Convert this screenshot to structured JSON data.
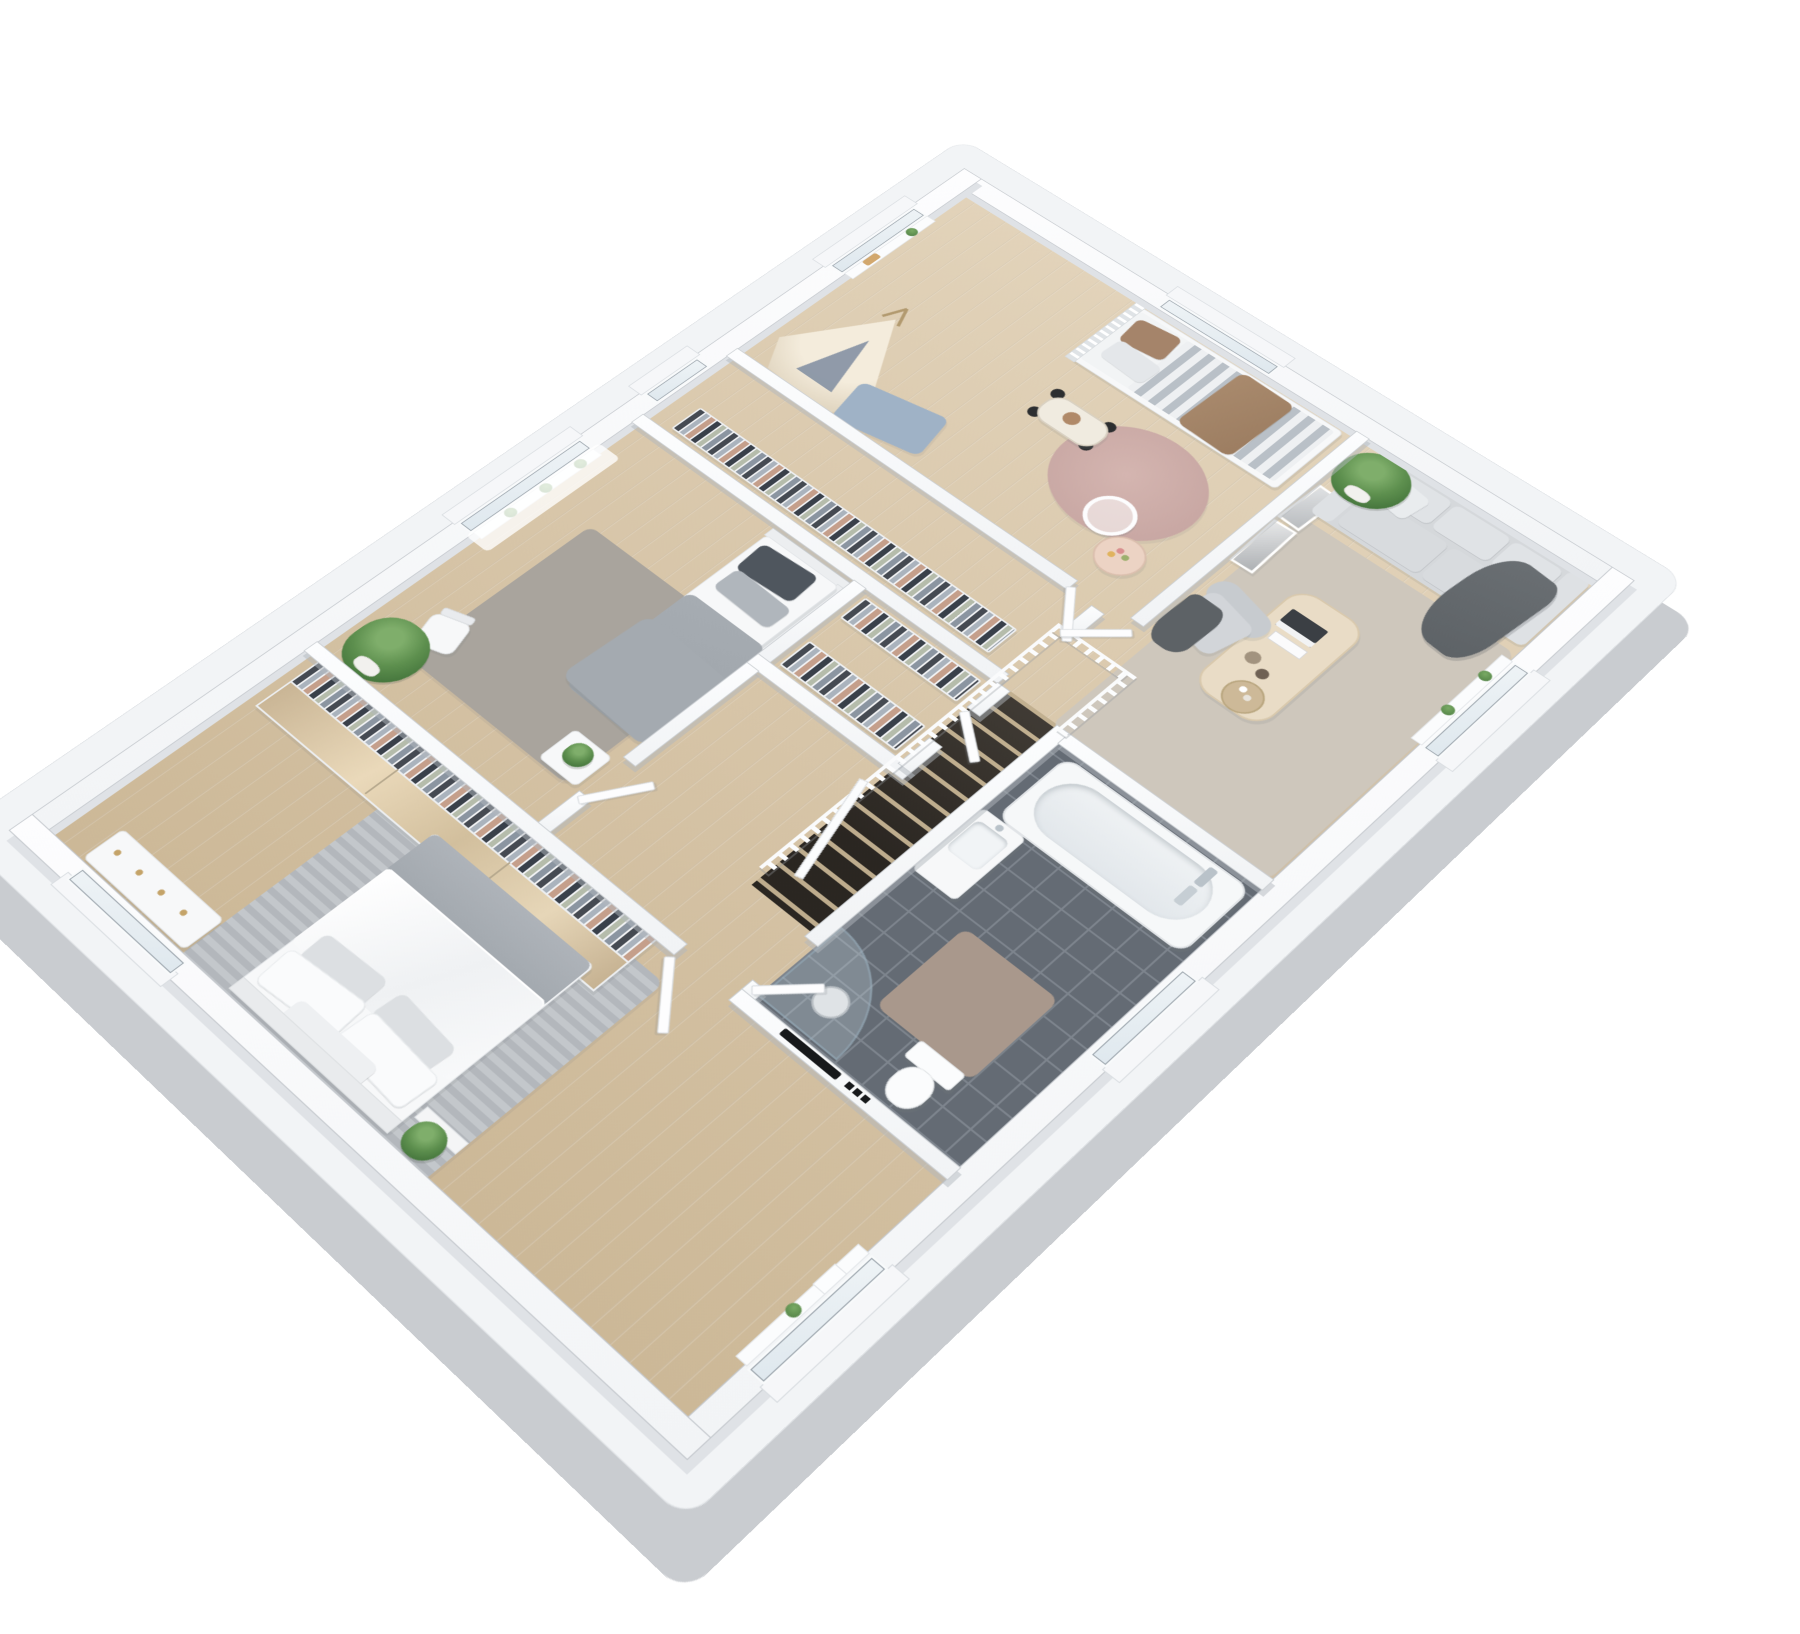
{
  "scene": {
    "type": "3d-floorplan-render",
    "view": "isometric-top-down",
    "floor_materials": {
      "main": "light-oak-plank",
      "bathroom": "anthracite-tile",
      "walls": "white"
    }
  },
  "colors": {
    "background": "#ffffff",
    "slab_top": "#f2f4f6",
    "slab_side": "#c9ccd0",
    "wall": "#fafbfc",
    "wall_edge": "#c5c9ce",
    "wood_light": "#e2d3ba",
    "wood_mid": "#d7c5a8",
    "wood_dark": "#ccb897",
    "tile_floor": "#646b74",
    "tile_grout": "#7d848d",
    "rug_lounge": "#cec7bc",
    "rug_master": "#b7babf",
    "rug_bedroom": "#a9a49d",
    "rug_kids": "#c8a7a3",
    "bath_mat": "#a9988c",
    "sofa": "#d5d8db",
    "throw_dark": "#5d6266",
    "bed_white": "#f5f6f7",
    "blanket_gray": "#9da3a9",
    "pillow_dark": "#4f565e",
    "kids_brown": "#9c7d61",
    "stair_void": "#413c36",
    "glass": "#dfe8ee",
    "plant_green": "#5d8f4e",
    "mirror_wood": "#d6c3a6",
    "tv_black": "#17191b"
  },
  "rooms": {
    "kids_bedroom": {
      "id": "kids-bedroom",
      "floor": "wood",
      "furniture": [
        "single-bed",
        "striped-duvet",
        "brown-pillow",
        "brown-throw",
        "teepee-tent",
        "blue-play-mat",
        "toy-pedal-car",
        "round-rug",
        "wire-chair",
        "play-table",
        "leaning-pictures"
      ],
      "windows": 2
    },
    "lounge": {
      "id": "lounge",
      "floor": "wood",
      "furniture": [
        "three-seat-sofa",
        "back-cushions",
        "seat-cushions",
        "dark-throw",
        "coffee-table",
        "books",
        "vases",
        "serving-tray",
        "armchair",
        "armchair-throw",
        "area-rug",
        "corner-potted-plant"
      ],
      "windows": 1
    },
    "bathroom": {
      "id": "bathroom",
      "floor": "dark-gray-tile",
      "walls": "white-subway-tile",
      "furniture": [
        "bathtub",
        "chrome-bath-mixer",
        "floating-vanity",
        "basin",
        "curved-shower-enclosure",
        "floor-drain",
        "toilet",
        "bath-mat"
      ],
      "windows": 1
    },
    "staircase": {
      "id": "staircase",
      "furniture": [
        "white-railing",
        "balusters",
        "descending-handrail",
        "wood-landing",
        "stair-void-with-treads"
      ]
    },
    "hallway": {
      "id": "hallway",
      "floor": "wood",
      "furniture": [
        "white-doors"
      ]
    },
    "closet_upper": {
      "id": "walk-in-closet-upper",
      "furniture": [
        "clothes-rail",
        "hanging-clothes"
      ],
      "windows": 1
    },
    "closet_lower": {
      "id": "walk-in-closet-lower",
      "furniture": [
        "clothes-rail",
        "hanging-clothes"
      ],
      "windows": 0
    },
    "left_bedroom": {
      "id": "left-bedroom",
      "floor": "wood",
      "furniture": [
        "single-bed",
        "dark-pillow",
        "gray-throw",
        "area-rug",
        "chair",
        "nightstand-with-plant",
        "floor-plant",
        "sill-plants",
        "curtain"
      ],
      "windows": 1
    },
    "master_bedroom": {
      "id": "master-bedroom",
      "floor": "wood",
      "furniture": [
        "double-bed",
        "white-duvet",
        "pillow-set",
        "gray-striped-rug",
        "open-wardrobe-with-clothes",
        "mirrored-sliding-wardrobe",
        "dresser",
        "wall-tv-niche",
        "bedside-plant",
        "sill-plant"
      ],
      "windows": 2
    }
  }
}
